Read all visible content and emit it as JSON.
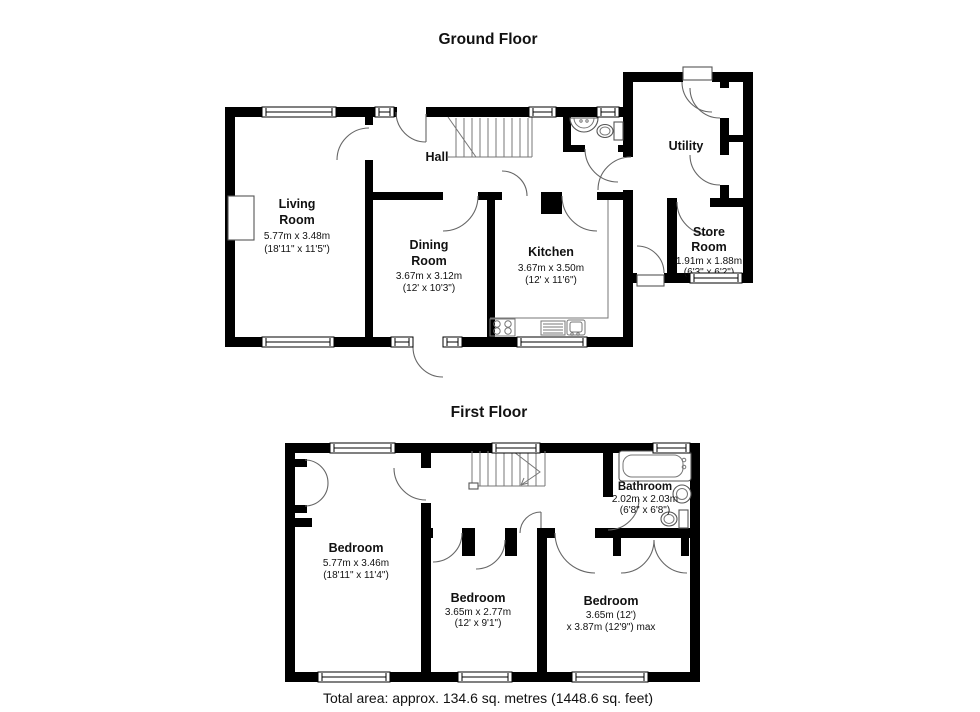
{
  "titles": {
    "ground": "Ground Floor",
    "first": "First Floor"
  },
  "footer": {
    "total_area": "Total area: approx. 134.6 sq. metres (1448.6 sq. feet)"
  },
  "colors": {
    "wall": "#000000",
    "background": "#ffffff"
  },
  "gf": {
    "hall": {
      "name": "Hall"
    },
    "utility": {
      "name": "Utility"
    },
    "living": {
      "n1": "Living",
      "n2": "Room",
      "m": "5.77m x 3.48m",
      "i": "(18'11\" x 11'5\")"
    },
    "dining": {
      "n1": "Dining",
      "n2": "Room",
      "m": "3.67m x 3.12m",
      "i": "(12' x 10'3\")"
    },
    "kitchen": {
      "n1": "Kitchen",
      "m": "3.67m x 3.50m",
      "i": "(12' x 11'6\")"
    },
    "store": {
      "n1": "Store",
      "n2": "Room",
      "m": "1.91m x 1.88m",
      "i": "(6'3\" x 6'2\")"
    }
  },
  "ff": {
    "bed1": {
      "n1": "Bedroom",
      "m": "5.77m x 3.46m",
      "i": "(18'11\" x 11'4\")"
    },
    "bed2": {
      "n1": "Bedroom",
      "m": "3.65m x 2.77m",
      "i": "(12' x 9'1\")"
    },
    "bed3": {
      "n1": "Bedroom",
      "m": "3.65m (12')",
      "i": "x 3.87m (12'9\") max"
    },
    "bath": {
      "n1": "Bathroom",
      "m": "2.02m x 2.03m",
      "i": "(6'8\" x 6'8\")"
    }
  }
}
